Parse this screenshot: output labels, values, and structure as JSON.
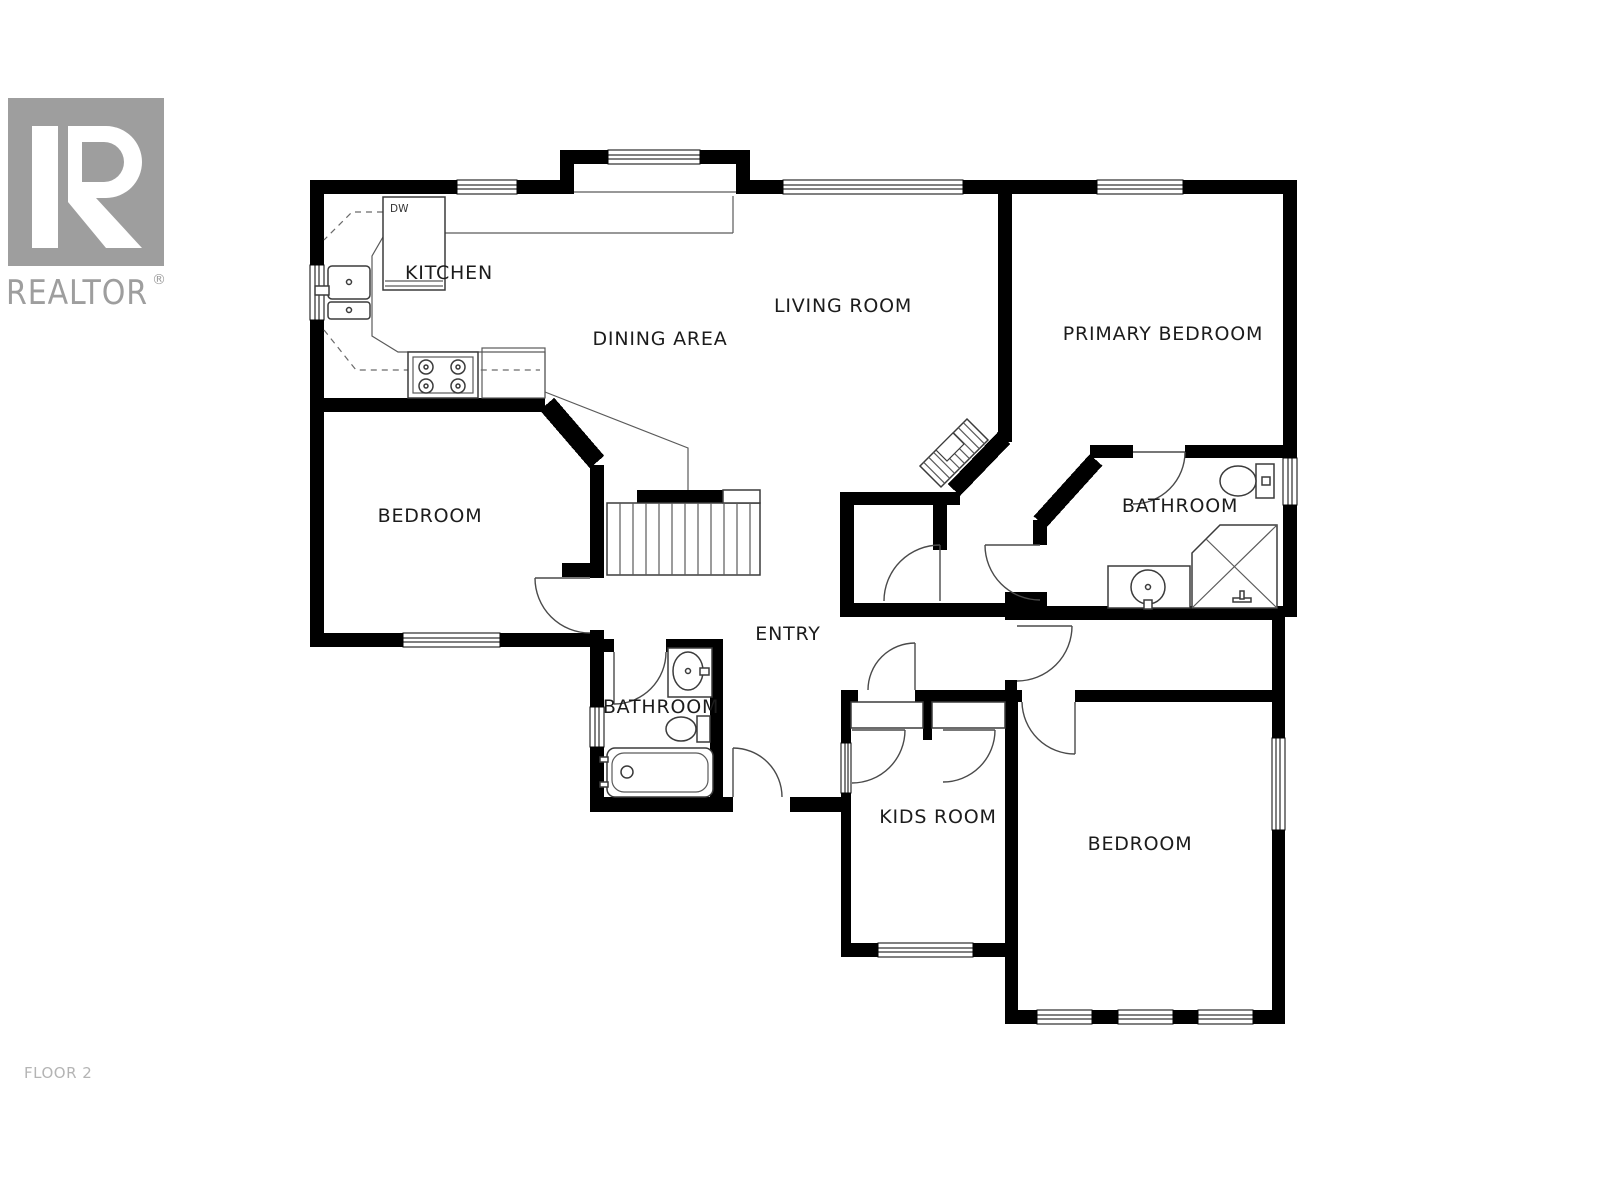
{
  "branding": {
    "logo_text": "REALTOR",
    "registered_mark": "®"
  },
  "floor_label": "FLOOR 2",
  "rooms": {
    "kitchen": "KITCHEN",
    "dining": "DINING AREA",
    "living": "LIVING ROOM",
    "primary_bedroom": "PRIMARY BEDROOM",
    "bedroom_west": "BEDROOM",
    "bathroom_ensuite": "BATHROOM",
    "entry": "ENTRY",
    "bathroom_main": "BATHROOM",
    "kids_room": "KIDS ROOM",
    "bedroom_south": "BEDROOM"
  },
  "appliances": {
    "dishwasher_label": "DW"
  },
  "colors": {
    "wall": "#000000",
    "logo_gray": "#9e9e9e",
    "floor_label_gray": "#b4b4b4",
    "label_ink": "#1c1c1c"
  }
}
